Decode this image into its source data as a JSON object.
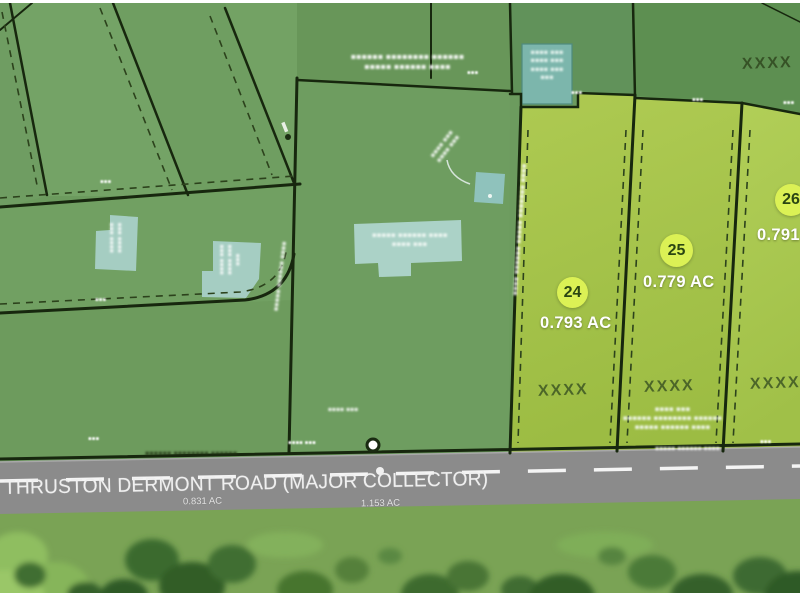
{
  "map_title": "parcel-plat-map",
  "road": {
    "name": "THRUSTON DERMONT ROAD (MAJOR COLLECTOR)",
    "area_label_left": "0.831 AC",
    "area_label_right": "1.153 AC"
  },
  "lots": [
    {
      "number": "24",
      "area": "0.793 AC",
      "marker": "XXXX"
    },
    {
      "number": "25",
      "area": "0.779 AC",
      "marker": "XXXX"
    },
    {
      "number": "26",
      "area": "0.791",
      "marker": "XXXX"
    }
  ],
  "adjacent_parcel_marker": "XXXX",
  "colors": {
    "lot_fill": "#a5c44b",
    "lot_fill_light": "#adcc54",
    "parcel_medium": "#6e9d60",
    "parcel_band": "#689659",
    "parcel_dark": "#5d8f51",
    "boundary_line": "#17270e",
    "building_fill": "#a9d0c5",
    "road_gray": "#8b8b8b",
    "badge_fill": "#dbf155",
    "badge_text": "#2b4612",
    "marker_text": "#3a5322",
    "grass": "#7aa355",
    "tree_dark": "#3a682e"
  },
  "illegible": {
    "s": "▪▪▪",
    "m": "▪▪▪▪ ▪▪▪",
    "l": "▪▪▪▪▪ ▪▪▪▪▪▪ ▪▪▪▪",
    "xl": "▪▪▪▪▪▪ ▪▪▪▪▪▪▪▪ ▪▪▪▪▪▪",
    "v": "▪▪▪▪ ▪▪▪▪▪▪ ▪▪▪▪▪ ▪▪▪▪▪▪▪ ▪▪▪▪"
  }
}
